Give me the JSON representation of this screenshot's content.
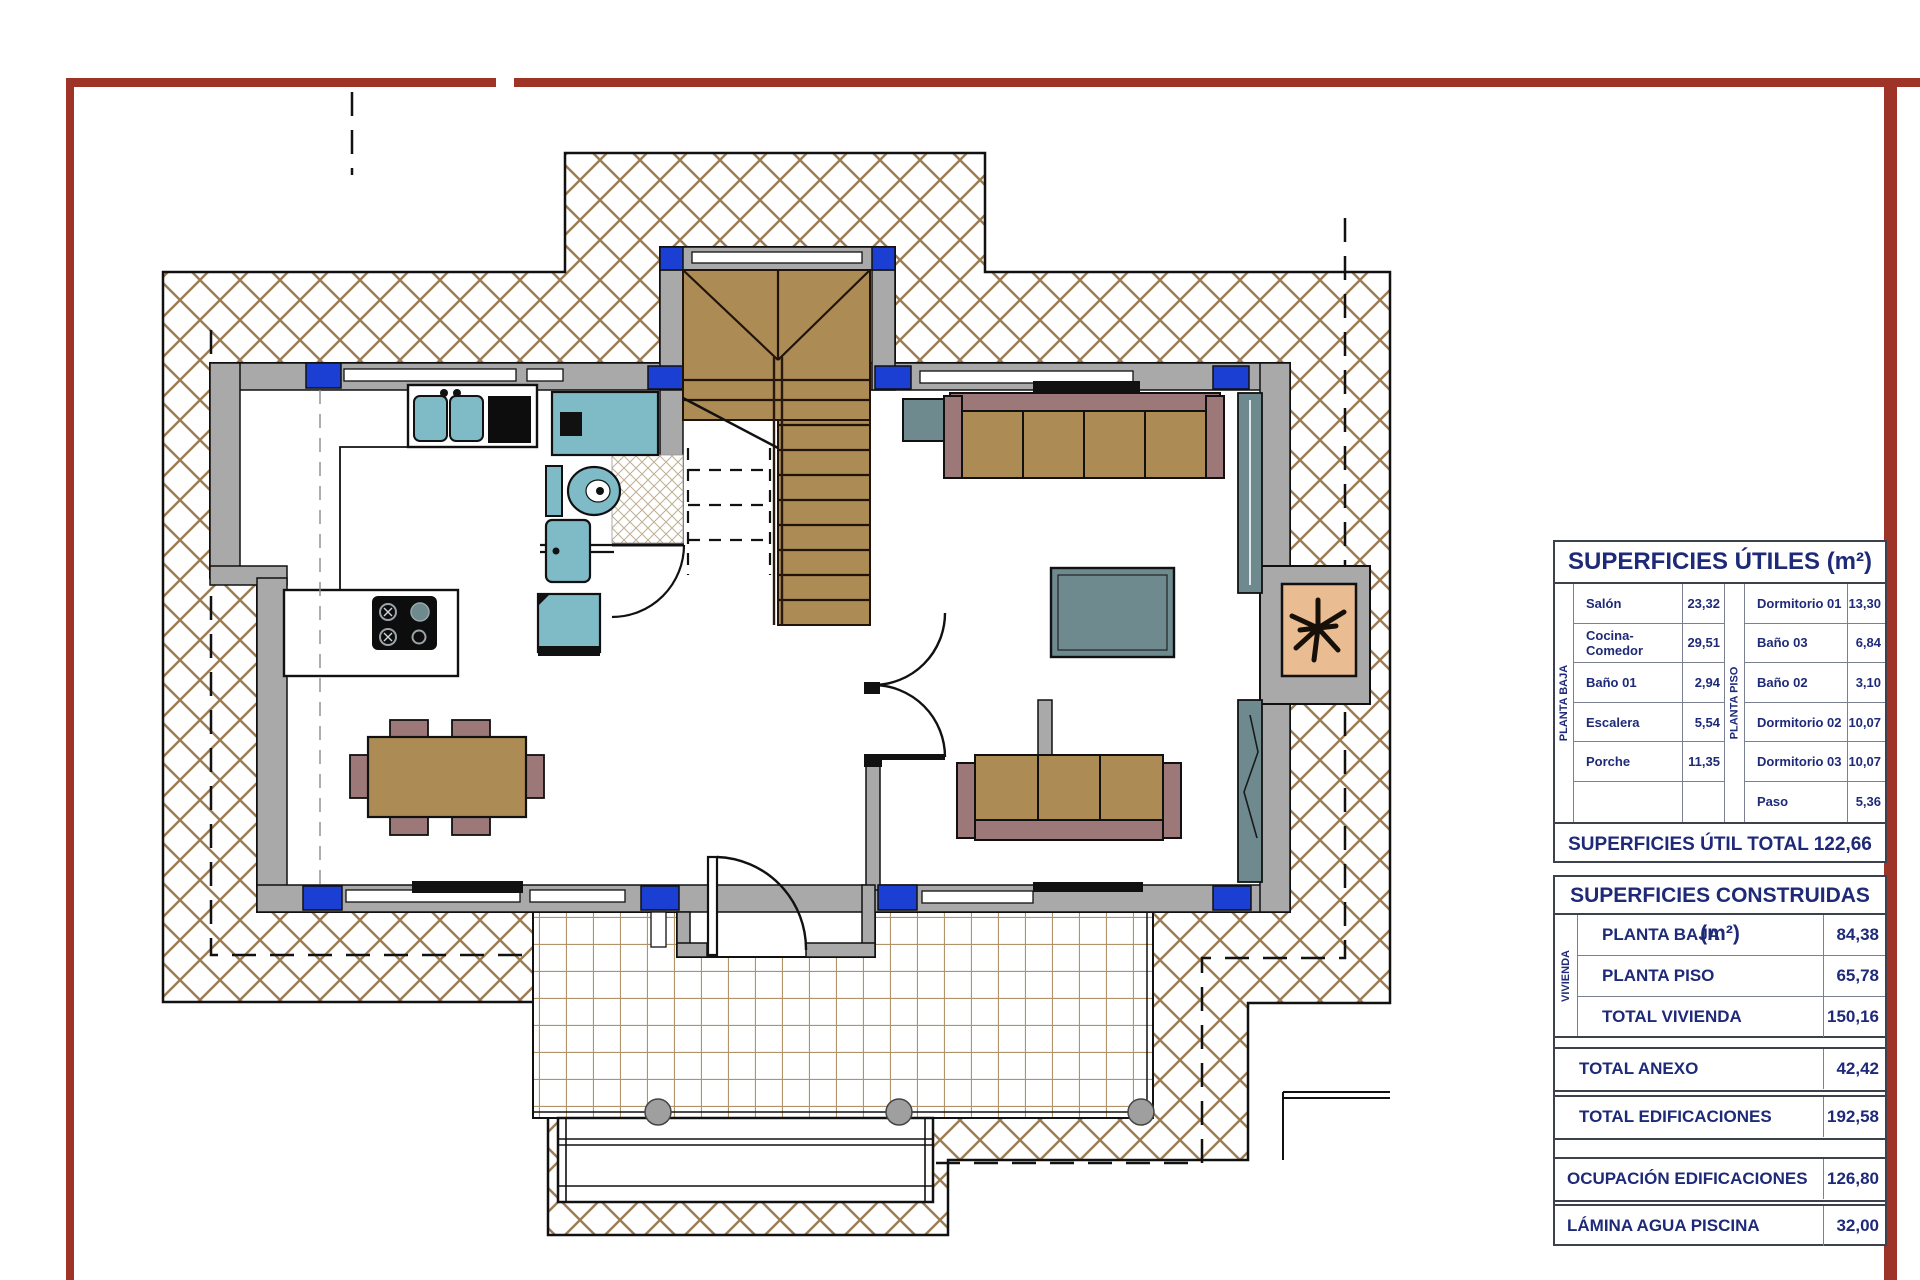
{
  "plan": {
    "description": "Ground floor plan of a house with exterior cross-hatched deck, tiled porch, stairs, kitchen, bathroom and living-dining furniture",
    "icons": {
      "plant-icon": "potted plant in chimney niche",
      "stairs-icon": "U-shaped staircase with winders",
      "door-swing-icon": "quarter-circle door swing arcs",
      "cooktop-icon": "4-burner hob",
      "toilet-icon": "WC with cistern",
      "sink-icon": "double-bowl kitchen sink"
    },
    "colors": {
      "page_border": "#9e3428",
      "deck_hatch": "#9c7c53",
      "wall_gray": "#a9a9a9",
      "window_blue": "#1b3ed3",
      "wood_tan": "#ac8b55",
      "upholstery_mauve": "#9c7878",
      "fixture_blue": "#7fbac7",
      "slate_gray": "#6e8a8e",
      "planter_tan": "#e9bc92",
      "table_text_navy": "#1e2a78"
    }
  },
  "tables": {
    "utiles": {
      "title": "SUPERFICIES ÚTILES (m²)",
      "groups": [
        {
          "label": "PLANTA BAJA",
          "rows": [
            {
              "name": "Salón",
              "value": "23,32"
            },
            {
              "name": "Cocina-Comedor",
              "value": "29,51"
            },
            {
              "name": "Baño 01",
              "value": "2,94"
            },
            {
              "name": "Escalera",
              "value": "5,54"
            },
            {
              "name": "Porche",
              "value": "11,35"
            },
            {
              "name": "",
              "value": ""
            }
          ]
        },
        {
          "label": "PLANTA PISO",
          "rows": [
            {
              "name": "Dormitorio 01",
              "value": "13,30"
            },
            {
              "name": "Baño 03",
              "value": "6,84"
            },
            {
              "name": "Baño 02",
              "value": "3,10"
            },
            {
              "name": "Dormitorio 02",
              "value": "10,07"
            },
            {
              "name": "Dormitorio 03",
              "value": "10,07"
            },
            {
              "name": "Paso",
              "value": "5,36"
            }
          ]
        }
      ],
      "total": "SUPERFICIES ÚTIL TOTAL 122,66 m²"
    },
    "construidas": {
      "title": "SUPERFICIES CONSTRUIDAS (m²)",
      "vivienda_label": "VIVIENDA",
      "vivienda_rows": [
        {
          "name": "PLANTA BAJA",
          "value": "84,38"
        },
        {
          "name": "PLANTA PISO",
          "value": "65,78"
        },
        {
          "name": "TOTAL VIVIENDA",
          "value": "150,16"
        }
      ],
      "summary_rows": [
        {
          "name": "TOTAL ANEXO",
          "value": "42,42"
        },
        {
          "name": "TOTAL EDIFICACIONES",
          "value": "192,58"
        },
        {
          "name": "OCUPACIÓN EDIFICACIONES",
          "value": "126,80"
        },
        {
          "name": "LÁMINA AGUA PISCINA",
          "value": "32,00"
        }
      ]
    }
  }
}
